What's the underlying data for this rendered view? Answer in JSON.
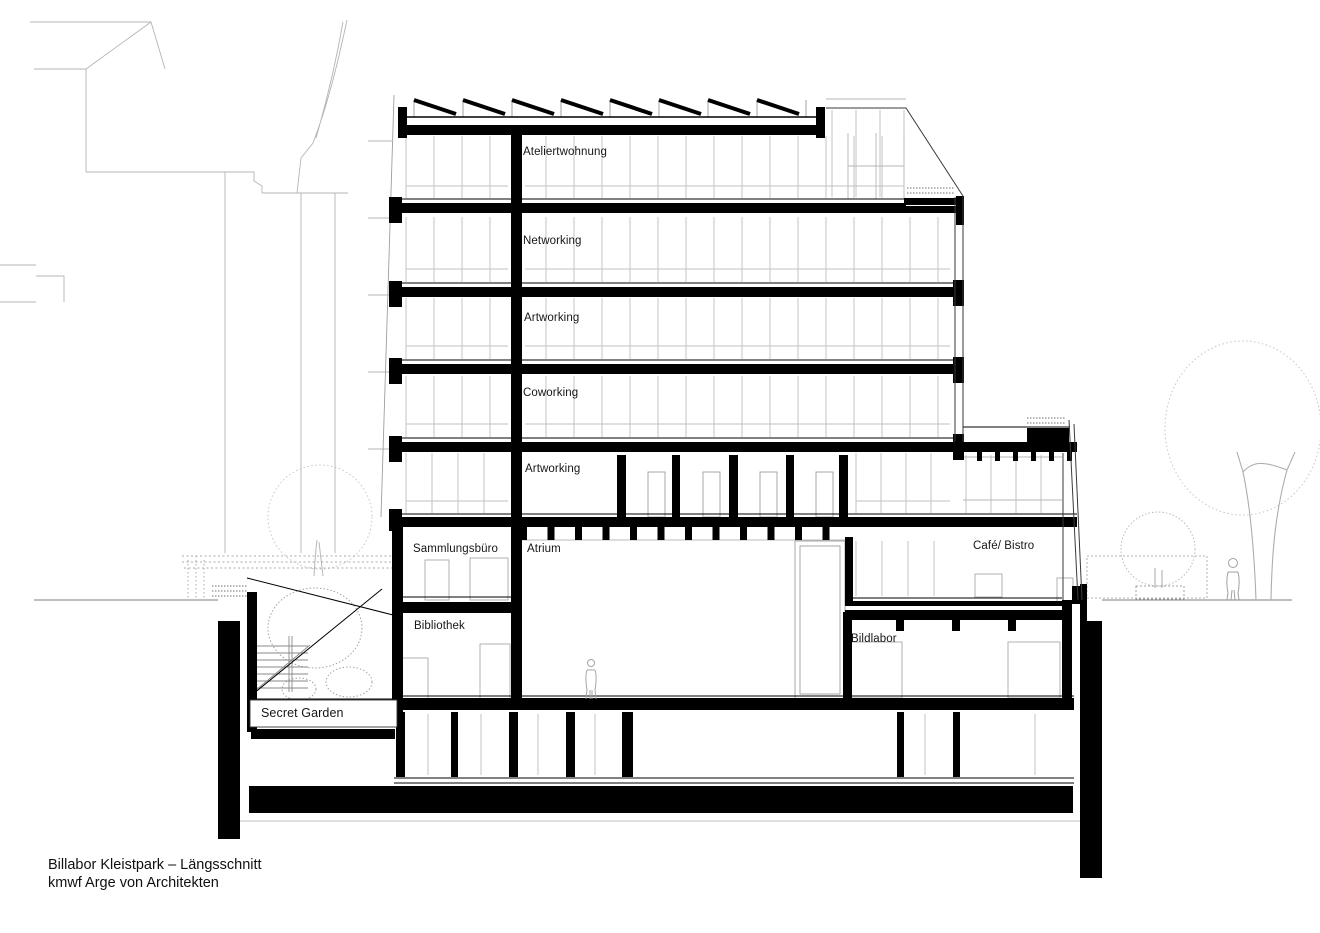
{
  "drawing": {
    "labels": {
      "ateliertwohnung": "Ateliertwohnung",
      "networking": "Networking",
      "artworking_upper": "Artworking",
      "coworking": "Coworking",
      "artworking_lower": "Artworking",
      "sammlungsbuero": "Sammlungsbüro",
      "atrium": "Atrium",
      "cafe_bistro": "Café/ Bistro",
      "bibliothek": "Bibliothek",
      "bildlabor": "Bildlabor",
      "secret_garden": "Secret Garden"
    },
    "title": {
      "line1": "Billabor Kleistpark – Längsschnitt",
      "line2": "kmwf Arge von Architekten"
    },
    "colors": {
      "ink": "#000000",
      "context_gray": "#b4b4b4",
      "background": "#ffffff"
    }
  }
}
